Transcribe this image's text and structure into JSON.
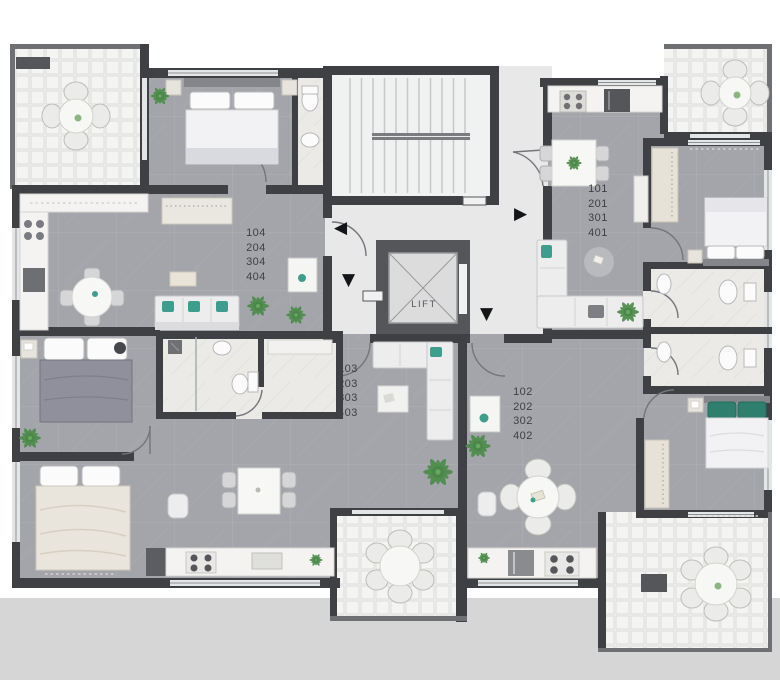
{
  "lift": {
    "label": "LIFT"
  },
  "units": {
    "top_left": {
      "lines": [
        "104",
        "204",
        "304",
        "404"
      ]
    },
    "top_right": {
      "lines": [
        "101",
        "201",
        "301",
        "401"
      ]
    },
    "bottom_left": {
      "lines": [
        "103",
        "203",
        "303",
        "403"
      ]
    },
    "bottom_right": {
      "lines": [
        "102",
        "202",
        "302",
        "402"
      ]
    }
  },
  "icons": {
    "entrance_arrow_left": "◀",
    "entrance_arrow_right": "▶",
    "entrance_arrow_down": "▼"
  },
  "colors": {
    "wall": "#3f4044",
    "floor_tile": "#a4a5aa",
    "balcony_tile": "#f1f1ef",
    "hallway": "#e8e8e8",
    "bathroom_marble": "#ebeae7",
    "accent_teal": "#3e9e8e",
    "bed_green_pillow": "#2e7f6e",
    "lower_background": "#d6d6d6",
    "arrow": "#141518"
  }
}
